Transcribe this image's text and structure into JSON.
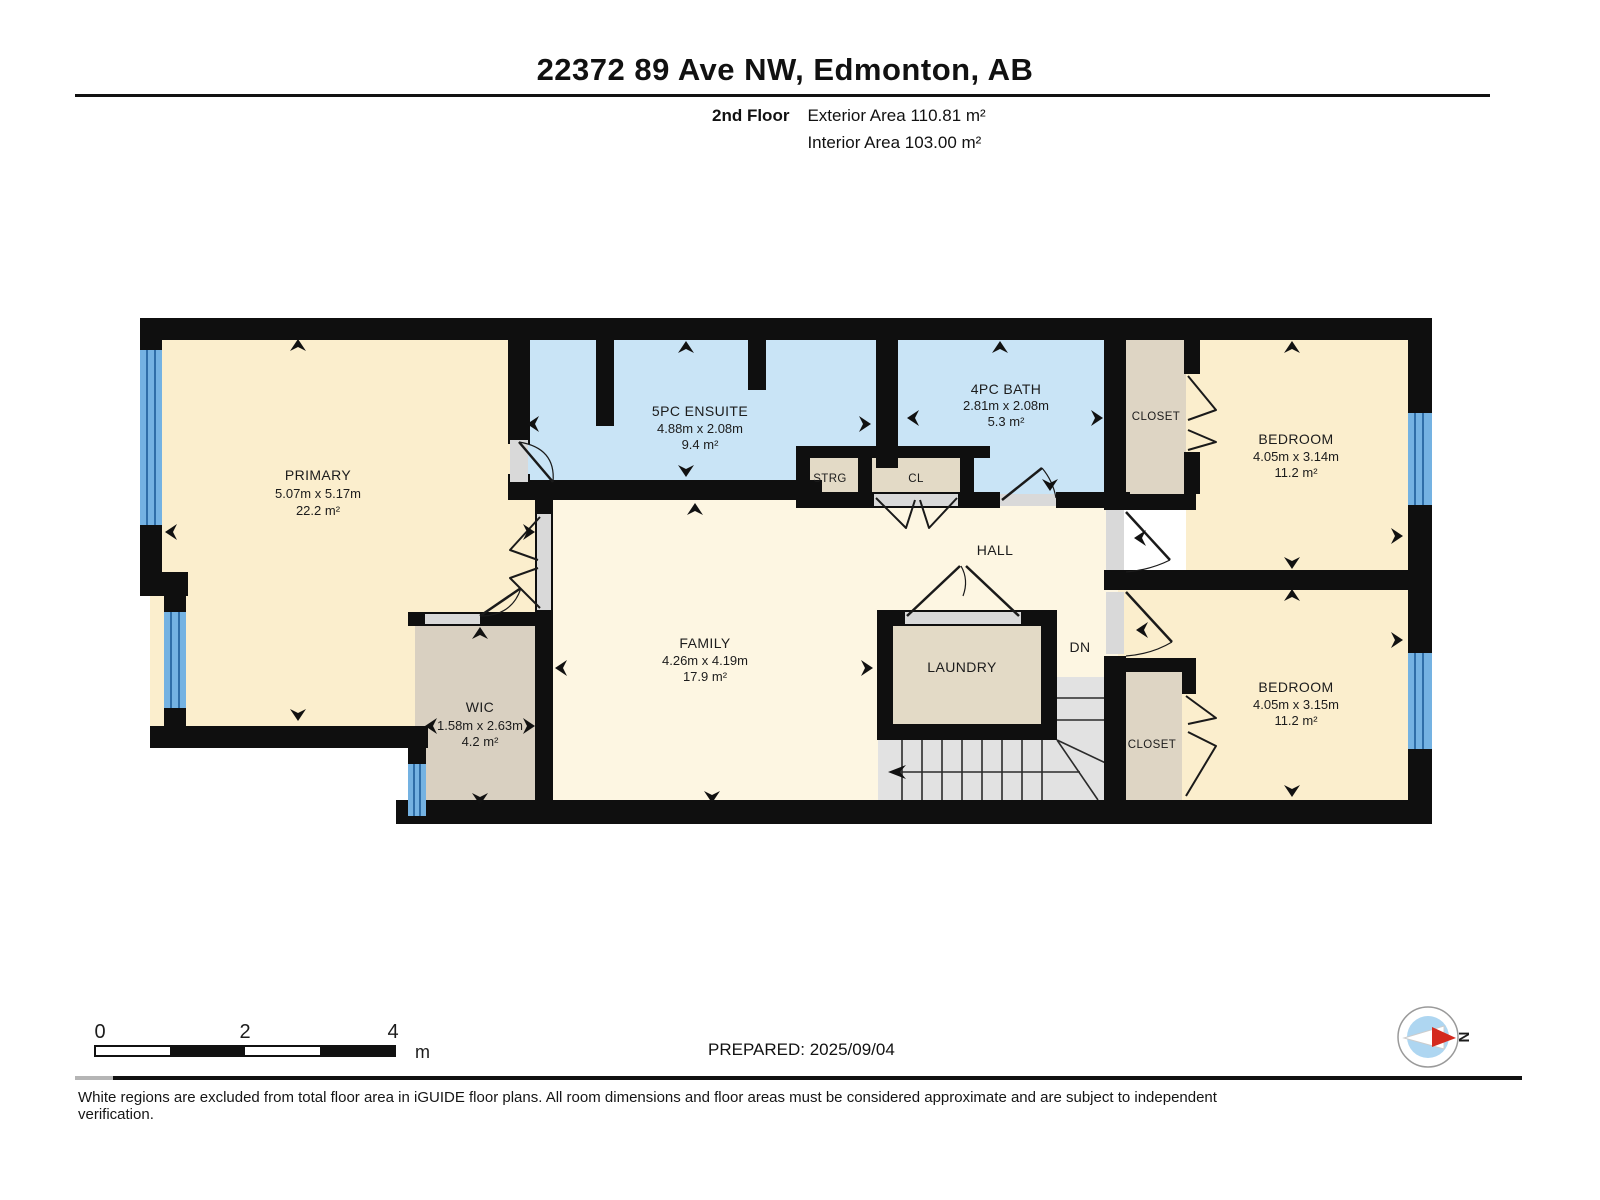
{
  "header": {
    "title": "22372 89 Ave NW, Edmonton, AB",
    "floor": "2nd Floor",
    "exterior_area": "Exterior Area 110.81 m²",
    "interior_area": "Interior Area 103.00 m²"
  },
  "rooms": {
    "primary": {
      "name": "PRIMARY",
      "dims": "5.07m x 5.17m",
      "area": "22.2 m²"
    },
    "ensuite": {
      "name": "5PC ENSUITE",
      "dims": "4.88m x 2.08m",
      "area": "9.4 m²"
    },
    "bath": {
      "name": "4PC BATH",
      "dims": "2.81m x 2.08m",
      "area": "5.3 m²"
    },
    "bedroom_top": {
      "name": "BEDROOM",
      "dims": "4.05m x 3.14m",
      "area": "11.2 m²"
    },
    "bedroom_bottom": {
      "name": "BEDROOM",
      "dims": "4.05m x 3.15m",
      "area": "11.2 m²"
    },
    "wic": {
      "name": "WIC",
      "dims": "1.58m x 2.63m",
      "area": "4.2 m²"
    },
    "family": {
      "name": "FAMILY",
      "dims": "4.26m x 4.19m",
      "area": "17.9 m²"
    },
    "laundry": {
      "name": "LAUNDRY"
    },
    "hall": {
      "name": "HALL"
    },
    "storage": {
      "name": "STRG"
    },
    "closet_hall": {
      "name": "CL"
    },
    "closet_top": {
      "name": "CLOSET"
    },
    "closet_bottom": {
      "name": "CLOSET"
    },
    "stairs_down": {
      "name": "DN"
    }
  },
  "scale_bar": {
    "ticks": [
      "0",
      "2",
      "4"
    ],
    "unit": "m"
  },
  "compass": {
    "north": "N"
  },
  "footer": {
    "prepared": "PREPARED: 2025/09/04",
    "disclaimer": "White regions are excluded from total floor area in iGUIDE floor plans. All room dimensions and floor areas must be considered approximate and are subject to independent verification."
  },
  "colors": {
    "room_cream": "#fbeecd",
    "room_cream_light": "#fdf6e2",
    "bath_blue": "#c9e4f6",
    "closet_tan": "#ded5c4",
    "wic_tan": "#d9d0c1",
    "laundry_tan": "#e3dac6",
    "stairs_gray": "#e2e2e2",
    "wall_black": "#0f0f0f",
    "window_blue": "#74b2e2",
    "window_stripe": "#2f6ea8",
    "opening_gray": "#d9d9d9",
    "compass_red": "#d42a1e",
    "compass_blue": "#aed6f1"
  }
}
